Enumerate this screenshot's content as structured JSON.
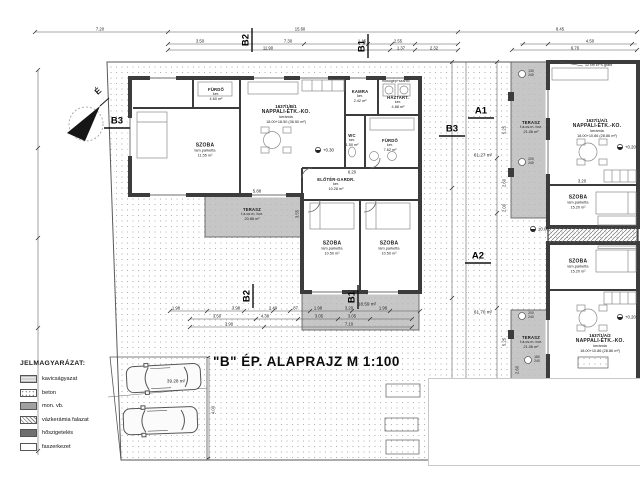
{
  "title": "\"B\" ÉP. ALAPRAJZ  M 1:100",
  "north": "É",
  "markers": {
    "b1": "B1",
    "b2": "B2",
    "b3": "B3",
    "a1": "A1",
    "a2": "A2"
  },
  "legend": {
    "heading": "JELMAGYARÁZAT:",
    "items": [
      {
        "label": "kavicságyazat"
      },
      {
        "label": "beton"
      },
      {
        "label": "mon. vb."
      },
      {
        "label": "vázkerámia falazat"
      },
      {
        "label": "hőszigetelés"
      },
      {
        "label": "faszerkezet"
      }
    ]
  },
  "units": {
    "b1": {
      "plot_id": "1637/1/B/1",
      "living": {
        "name": "NAPPALI-ÉTK.-KO.",
        "finish": "kerámia",
        "area": "18.00+18.50 (36.50 m²)"
      },
      "szoba1": {
        "name": "SZOBA",
        "finish": "lam.parketta",
        "area": "11.55 m²"
      },
      "furdo1": {
        "name": "FÜRDŐ",
        "finish": "ker.",
        "area": "4.60 m²"
      },
      "kamra": {
        "name": "KAMRA",
        "finish": "ker.",
        "area": "2.42 m²"
      },
      "haztart": {
        "name": "HÁZTART.",
        "finish": "ker.",
        "area": "4.88 m²",
        "note": "mosógép+szárító"
      },
      "furdo2": {
        "name": "FÜRDŐ",
        "finish": "ker.",
        "area": "7.62 m²"
      },
      "wc": {
        "name": "WC",
        "finish": "ker.",
        "area": "1.50 m²"
      },
      "eloter": {
        "name": "ELŐTÉR-GARDR.",
        "finish": "ker.",
        "area": "10.28 m²"
      },
      "szoba2": {
        "name": "SZOBA",
        "finish": "lam.parketta",
        "area": "10.50 m²"
      },
      "szoba3": {
        "name": "SZOBA",
        "finish": "lam.parketta",
        "area": "10.50 m²"
      },
      "terasz": {
        "name": "TERASZ",
        "finish": "f.a.cs.m. bor.",
        "area": "20.88 m²"
      },
      "walk_area": "18.59 m²"
    },
    "a1": {
      "plot_id": "1637/1/A/1",
      "living": {
        "name": "NAPPALI-ÉTK.-KO.",
        "finish": "kerámia",
        "area": "18.00+10.86 (28.86 m²)"
      },
      "szoba": {
        "name": "SZOBA",
        "finish": "lam.parketta",
        "area": "15.20 m²"
      },
      "terasz": {
        "name": "TERASZ",
        "finish": "f.a.cs.m. bor.",
        "area": "21.06 m²"
      },
      "site_area": "61.27 m²"
    },
    "a2": {
      "plot_id": "1637/1/A/2",
      "living": {
        "name": "NAPPALI-ÉTK.-KO.",
        "finish": "kerámia",
        "area": "18.00+10.86 (28.86 m²)"
      },
      "szoba": {
        "name": "SZOBA",
        "finish": "lam.parketta",
        "area": "15.20 m²"
      },
      "terasz": {
        "name": "TERASZ",
        "finish": "f.a.cs.m. bor.",
        "area": "21.06 m²"
      },
      "site_area": "61.70 m²"
    }
  },
  "site": {
    "parking_area": "39.28 m²"
  },
  "levels": {
    "l1": "+0.30",
    "l2": "+0.20",
    "l3": "+0.20",
    "l4": "±0.00"
  },
  "notes": {
    "eps": "12 cm EPS grafit"
  },
  "windows": [
    {
      "w": "130",
      "h": "240"
    },
    {
      "w": "200",
      "h": "240"
    },
    {
      "w": "200",
      "h": "240"
    },
    {
      "w": "180",
      "h": "240"
    }
  ],
  "dims": {
    "t1": "7.20",
    "t2": "15.60",
    "t3": "8.45",
    "t4": "11.90",
    "t5": "7.30",
    "t6": "1.15",
    "t7": "2.55",
    "t8": "1.37",
    "t9": "2.32",
    "t10": "4.50",
    "t11": "6.70",
    "t12": "3.50",
    "b1": "1.98",
    "b2": "3.98",
    "b3": "2.49",
    "b4": ".87",
    "b5": "1.98",
    "b6": "3.20",
    "b7": "1.98",
    "b8": "3.50",
    "b9": "4.38",
    "b10": "3.05",
    "b11": "3.05",
    "b12": "3.90",
    "b13": "7.10",
    "r1": "5.25",
    "r2": "2.60",
    "r3": "2.00",
    "r4": "5.25",
    "r5": "2.60",
    "r6": "5.88",
    "r7": "3.55",
    "r8": "3.20",
    "r9": "6.20",
    "r10": "4.00"
  }
}
